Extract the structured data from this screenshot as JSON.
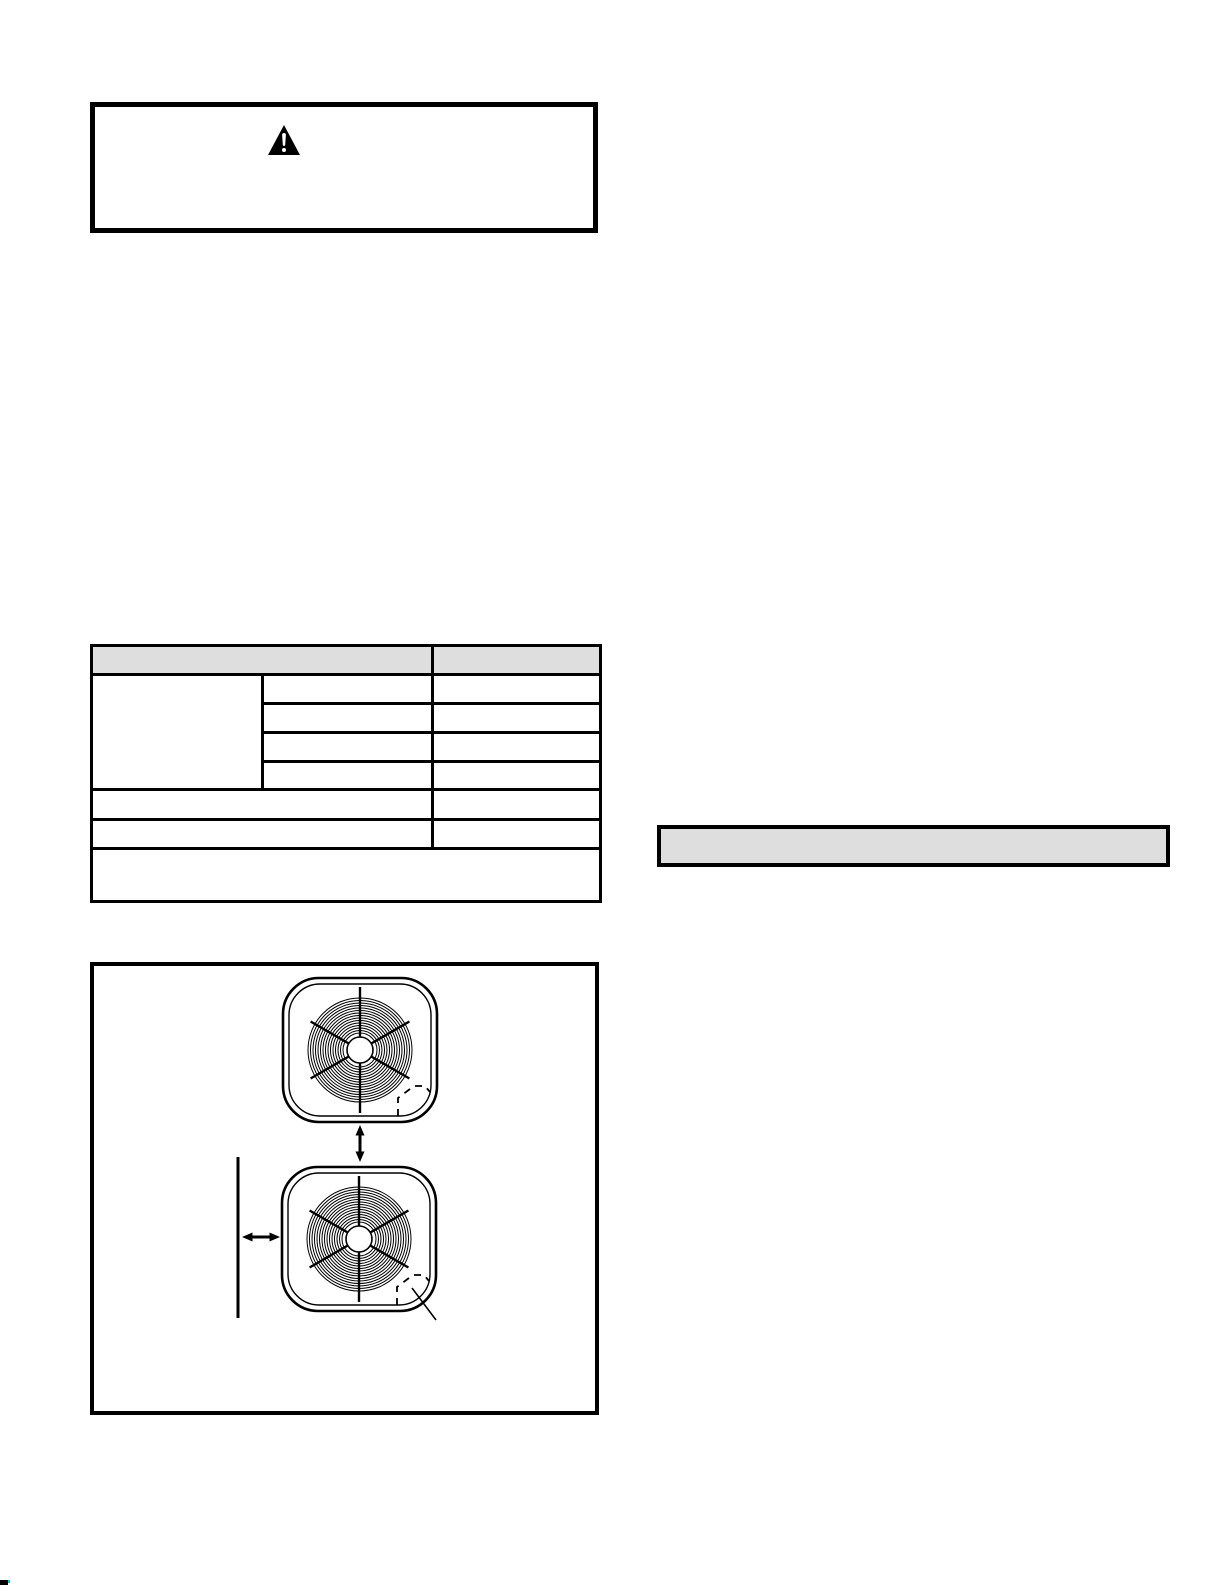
{
  "page": {
    "background": "#ffffff",
    "ink": "#000000",
    "gray_fill": "#dedede",
    "corner_mark_accent": "#00c8df"
  },
  "warning_box": {
    "icon": "warning-triangle",
    "heading": "",
    "body_text": ""
  },
  "spec_table": {
    "columns": 3,
    "header": {
      "left": "",
      "right": ""
    },
    "merged_left_cell": "",
    "detail_rows": [
      {
        "label": "",
        "value": ""
      },
      {
        "label": "",
        "value": ""
      },
      {
        "label": "",
        "value": ""
      },
      {
        "label": "",
        "value": ""
      }
    ],
    "wide_rows": [
      {
        "label": "",
        "value": ""
      },
      {
        "label": "",
        "value": ""
      }
    ],
    "footer_note": ""
  },
  "highlight_bar": {
    "text": ""
  },
  "figure": {
    "caption": "",
    "elements": {
      "top_unit": "fan-unit-grille",
      "bottom_unit": "fan-unit-grille",
      "vertical_spacing_arrow": "double-headed-arrow",
      "wall_line": "wall-edge",
      "wall_clearance_arrow": "double-headed-arrow",
      "corner_cutout": "dashed-knockout",
      "callout_leader": "leader-line"
    }
  }
}
